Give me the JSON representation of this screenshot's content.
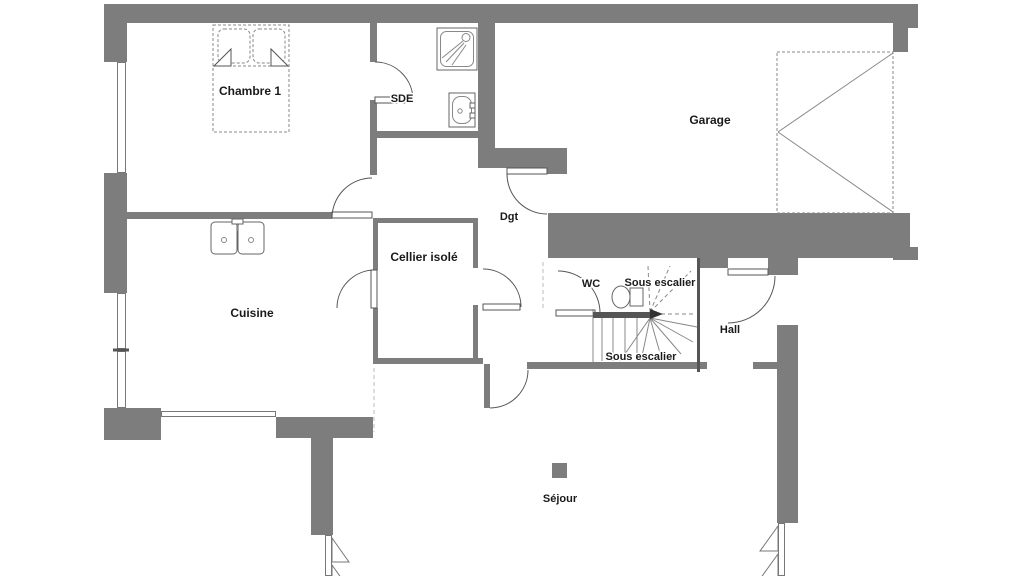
{
  "plan": {
    "title": "Floor plan ground level",
    "rooms": [
      {
        "name": "chambre-1",
        "label": "Chambre 1"
      },
      {
        "name": "sde",
        "label": "SDE"
      },
      {
        "name": "garage",
        "label": "Garage"
      },
      {
        "name": "degagement",
        "label": "Dgt"
      },
      {
        "name": "cellier-isole",
        "label": "Cellier isolé"
      },
      {
        "name": "cuisine",
        "label": "Cuisine"
      },
      {
        "name": "wc",
        "label": "WC"
      },
      {
        "name": "sous-escalier-haut",
        "label": "Sous escalier"
      },
      {
        "name": "sous-escalier-bas",
        "label": "Sous escalier"
      },
      {
        "name": "hall",
        "label": "Hall"
      },
      {
        "name": "sejour",
        "label": "Séjour"
      }
    ],
    "fixtures": [
      "double-bed",
      "shower-tray",
      "washbasin",
      "kitchen-double-sink",
      "toilet",
      "winder-staircase",
      "garage-sectional-door",
      "structural-post",
      "casement-window",
      "entrance-door"
    ],
    "colors": {
      "wall": "#7d7d7d",
      "stair_wall": "#555555",
      "fixture_line": "#888888",
      "door_line": "#555555",
      "dashed_boundary": "#bbbbbb",
      "text": "#1a1a1a",
      "background": "#ffffff"
    }
  }
}
